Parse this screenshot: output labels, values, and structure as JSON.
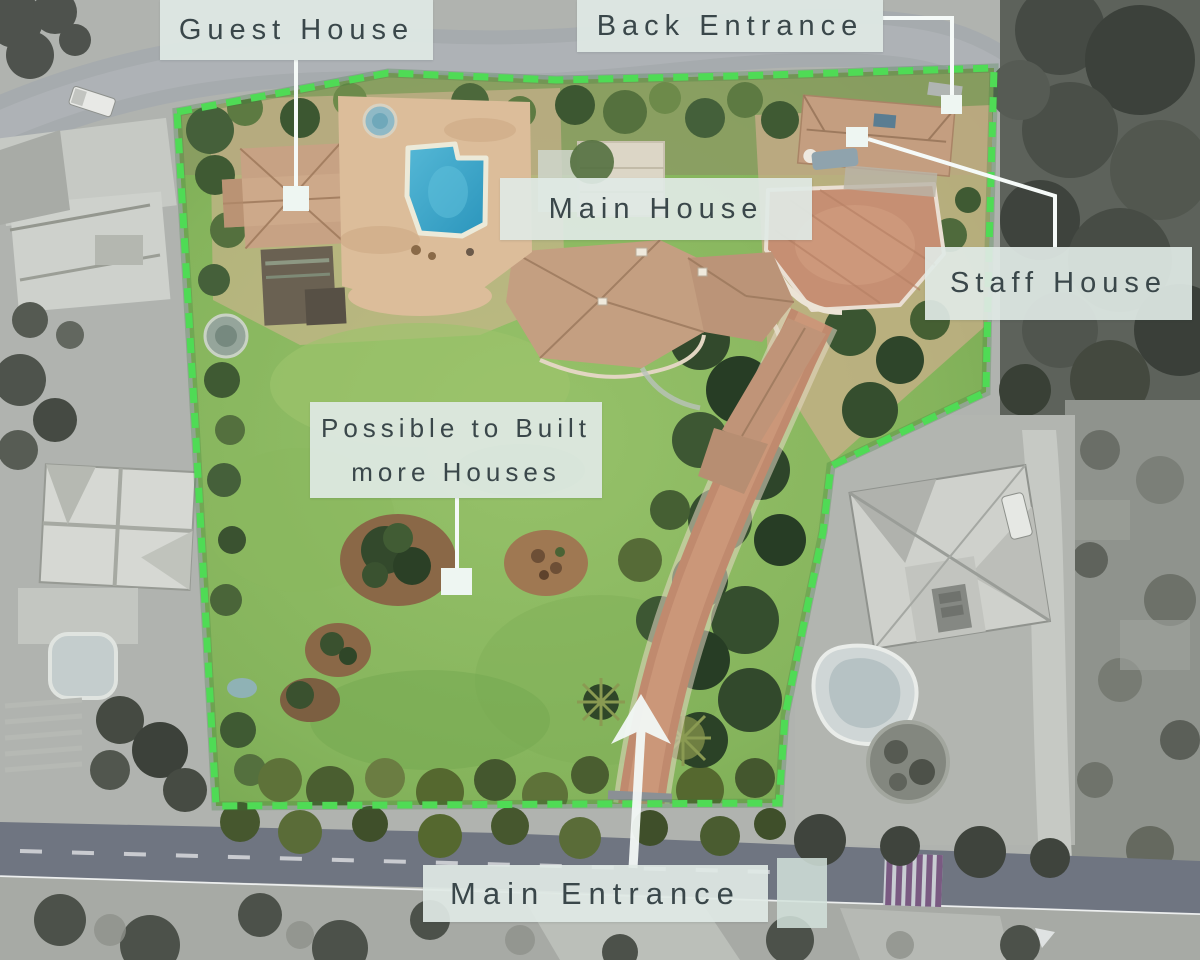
{
  "labels": {
    "guest_house": {
      "text": "Guest House"
    },
    "back_entrance": {
      "text": "Back Entrance"
    },
    "main_house": {
      "text": "Main House"
    },
    "staff_house": {
      "text": "Staff House"
    },
    "possible_build": {
      "line1": "Possible to Built",
      "line2": "more Houses"
    },
    "main_entrance": {
      "text": "Main Entrance"
    }
  },
  "colors": {
    "boundary_green": "#4fdb55",
    "label_bg": "rgba(223,233,229,0.92)",
    "label_text": "#3a474a",
    "leader_white": "#f5faf8",
    "marker_white": "#eef6f2",
    "pool_blue": "#35a3c8",
    "lawn_green": "#85b45c",
    "roof_terracotta": "#c49f81"
  }
}
